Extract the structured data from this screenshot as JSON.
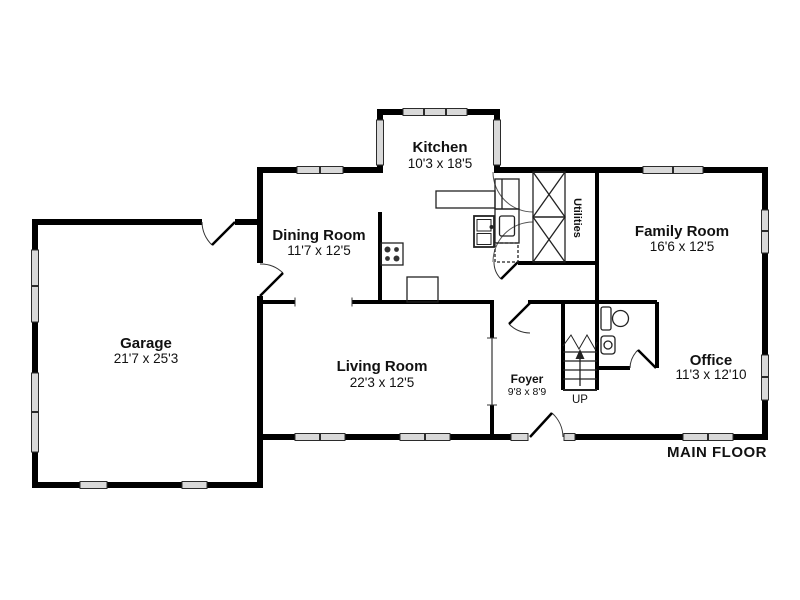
{
  "floor_plan": {
    "title": "MAIN FLOOR",
    "rooms": [
      {
        "id": "kitchen",
        "name": "Kitchen",
        "dims": "10'3 x 18'5"
      },
      {
        "id": "dining",
        "name": "Dining Room",
        "dims": "11'7 x 12'5"
      },
      {
        "id": "family",
        "name": "Family Room",
        "dims": "16'6 x 12'5"
      },
      {
        "id": "garage",
        "name": "Garage",
        "dims": "21'7 x 25'3"
      },
      {
        "id": "living",
        "name": "Living Room",
        "dims": "22'3 x 12'5"
      },
      {
        "id": "foyer",
        "name": "Foyer",
        "dims": "9'8 x 8'9"
      },
      {
        "id": "office",
        "name": "Office",
        "dims": "11'3 x 12'10"
      }
    ],
    "closet_label": "Utilities",
    "stairs_label": "UP",
    "colors": {
      "wall": "#000000",
      "window_fill": "#d9d9d9",
      "background": "#ffffff"
    }
  }
}
